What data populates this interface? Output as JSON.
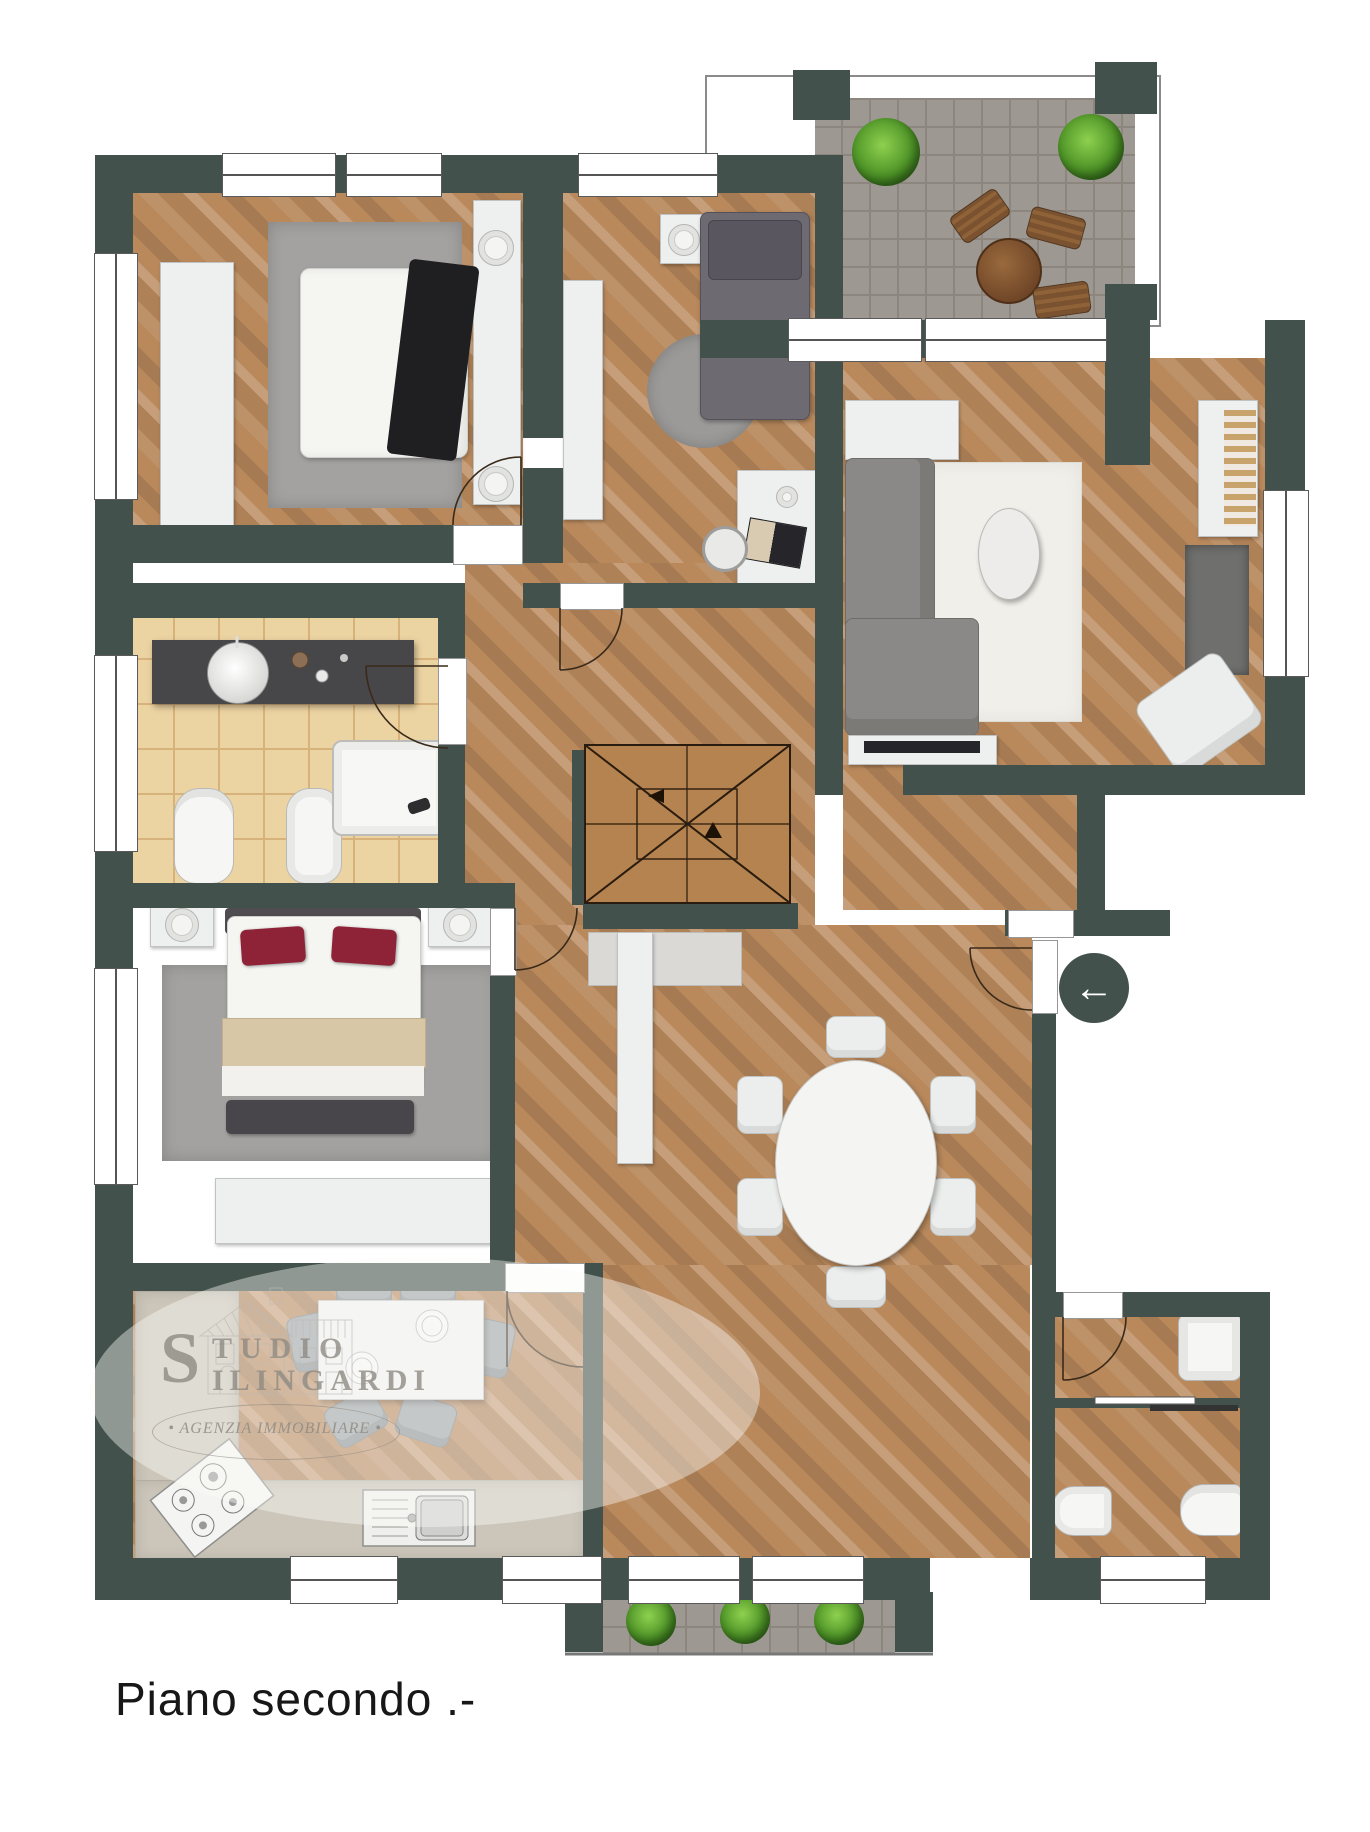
{
  "caption": {
    "text": "Piano secondo .-"
  },
  "watermark": {
    "initial": "S",
    "line1": "TUDIO",
    "line2": "ILINGARDI",
    "tagline": "• AGENZIA IMMOBILIARE •"
  },
  "entry": {
    "arrow_glyph": "←"
  },
  "palette": {
    "wall": "#42514b",
    "wood": "#b9895c",
    "tile": "#ecd3a2",
    "paver": "#9e9892",
    "counter": "#ccc6ba",
    "stair": "#b5834f",
    "accent_red": "#8e2338",
    "plant_green": "#4e9427"
  }
}
